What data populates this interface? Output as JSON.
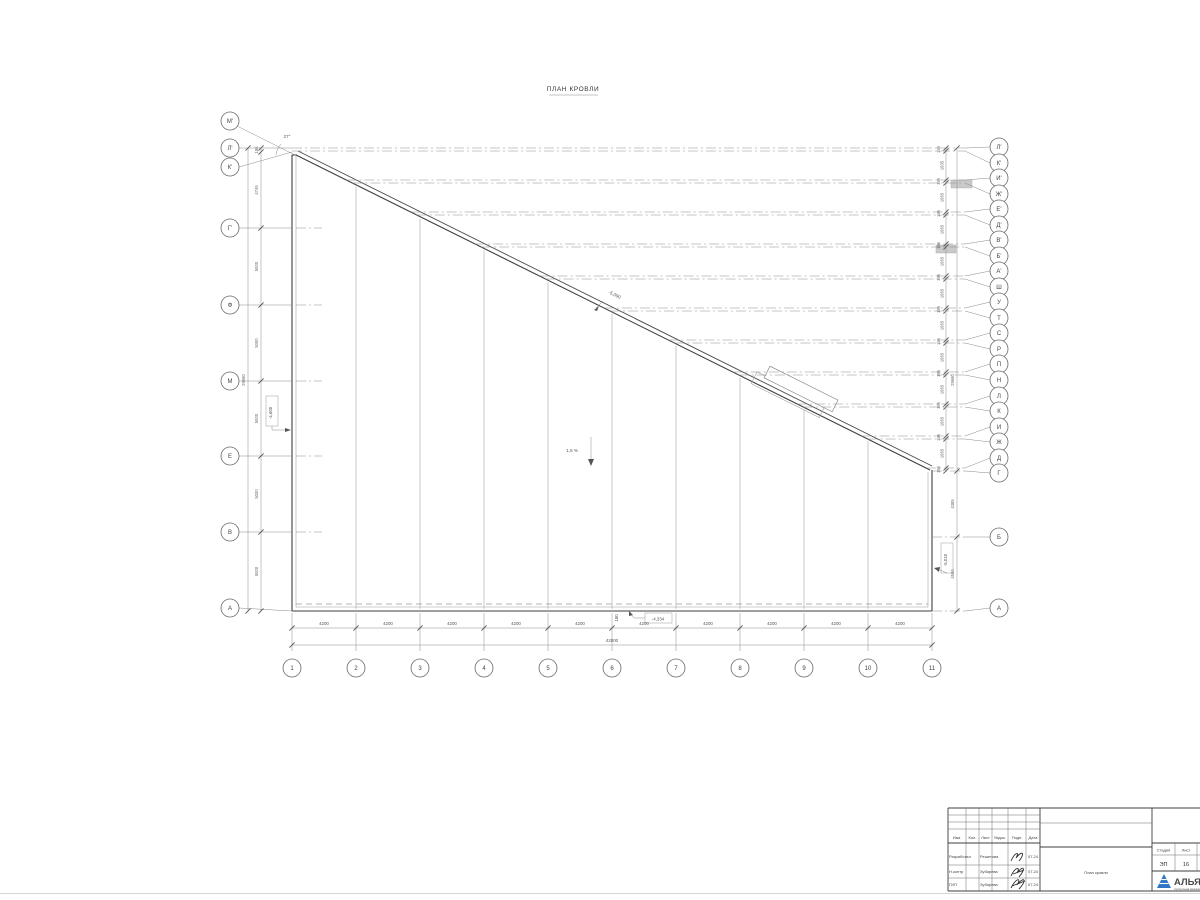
{
  "title": "ПЛАН КРОВЛИ",
  "grid": {
    "bottom": {
      "axis_labels": [
        "1",
        "2",
        "3",
        "4",
        "5",
        "6",
        "7",
        "8",
        "9",
        "10",
        "11"
      ],
      "spacings": [
        "4200",
        "4200",
        "4200",
        "4200",
        "4200",
        "4200",
        "4200",
        "4200",
        "4200",
        "4200"
      ],
      "total": "42000"
    },
    "left_axes": [
      {
        "label": "М'",
        "diag": true,
        "cy": 121
      },
      {
        "label": "Л'",
        "y": 148,
        "cy": 148
      },
      {
        "label": "К'",
        "y": 152,
        "cy": 167
      },
      {
        "label": "Г'",
        "y": 228,
        "cy": 228,
        "stub": true
      },
      {
        "label": "Ф",
        "y": 305,
        "cy": 305,
        "stub": true
      },
      {
        "label": "М",
        "y": 381,
        "cy": 381,
        "stub": true
      },
      {
        "label": "Е",
        "y": 456,
        "cy": 456,
        "stub": true
      },
      {
        "label": "В",
        "y": 532,
        "cy": 532,
        "stub": true
      },
      {
        "label": "А",
        "y": 611,
        "cy": 608
      }
    ],
    "left_dims": {
      "chain_labels": [
        "195",
        "4745",
        "5000",
        "5000",
        "5000",
        "5000",
        "5000"
      ],
      "total": "29680"
    },
    "right_axes": [
      [
        "Л'",
        148,
        147
      ],
      [
        "К'",
        151,
        163
      ],
      [
        "И'",
        180,
        178
      ],
      [
        "Ж'",
        183,
        194
      ],
      [
        "Е'",
        212,
        209
      ],
      [
        "Д'",
        215,
        225
      ],
      [
        "В'",
        244,
        240
      ],
      [
        "Б'",
        247,
        256
      ],
      [
        "А'",
        276,
        271
      ],
      [
        "Ш",
        279,
        287
      ],
      [
        "У",
        308,
        302
      ],
      [
        "Т",
        311,
        318
      ],
      [
        "С",
        340,
        333
      ],
      [
        "Р",
        343,
        349
      ],
      [
        "П",
        372,
        364
      ],
      [
        "Н",
        375,
        380
      ],
      [
        "Л",
        404,
        396
      ],
      [
        "К",
        407,
        411
      ],
      [
        "И",
        436,
        427
      ],
      [
        "Ж",
        439,
        442
      ],
      [
        "Д",
        468,
        458
      ],
      [
        "Г",
        471,
        473
      ],
      [
        "Б",
        537,
        537
      ],
      [
        "А",
        611,
        608
      ]
    ],
    "right_dims": {
      "chain_labels": [
        "195",
        "1935",
        "195",
        "1965",
        "195",
        "1965",
        "195",
        "1965",
        "195",
        "1965",
        "195",
        "1965",
        "195",
        "1965",
        "195",
        "1965",
        "195",
        "1965",
        "195",
        "1965",
        "195"
      ],
      "outer_labels": [
        "29680",
        "4385",
        "4500"
      ]
    }
  },
  "annotations": {
    "slope_elev": "-5,090",
    "slope_pct": "1,5 %",
    "elev_left": "-4,600",
    "elev_right": "-5,010",
    "elev_bottom": "-4,334",
    "parapet": "180",
    "angle": "27°"
  },
  "titleblock": {
    "header_cols": [
      "Изм.",
      "Кол.",
      "Лист",
      "№док.",
      "Подп.",
      "Дата"
    ],
    "rows": [
      {
        "role": "Разработал",
        "name": "Решетова",
        "date": "07.24"
      },
      {
        "role": "Н.контр",
        "name": "Зубарева",
        "date": "07.24"
      },
      {
        "role": "ГИП",
        "name": "Зубарева",
        "date": "07.24"
      }
    ],
    "doc_title": "План кровли",
    "stage_label": "Стадия",
    "stage": "ЭП",
    "sheet_label": "Лист",
    "sheet": "16",
    "logo_text": "АЛЬЯН",
    "logo_sub": "строительная компания"
  }
}
